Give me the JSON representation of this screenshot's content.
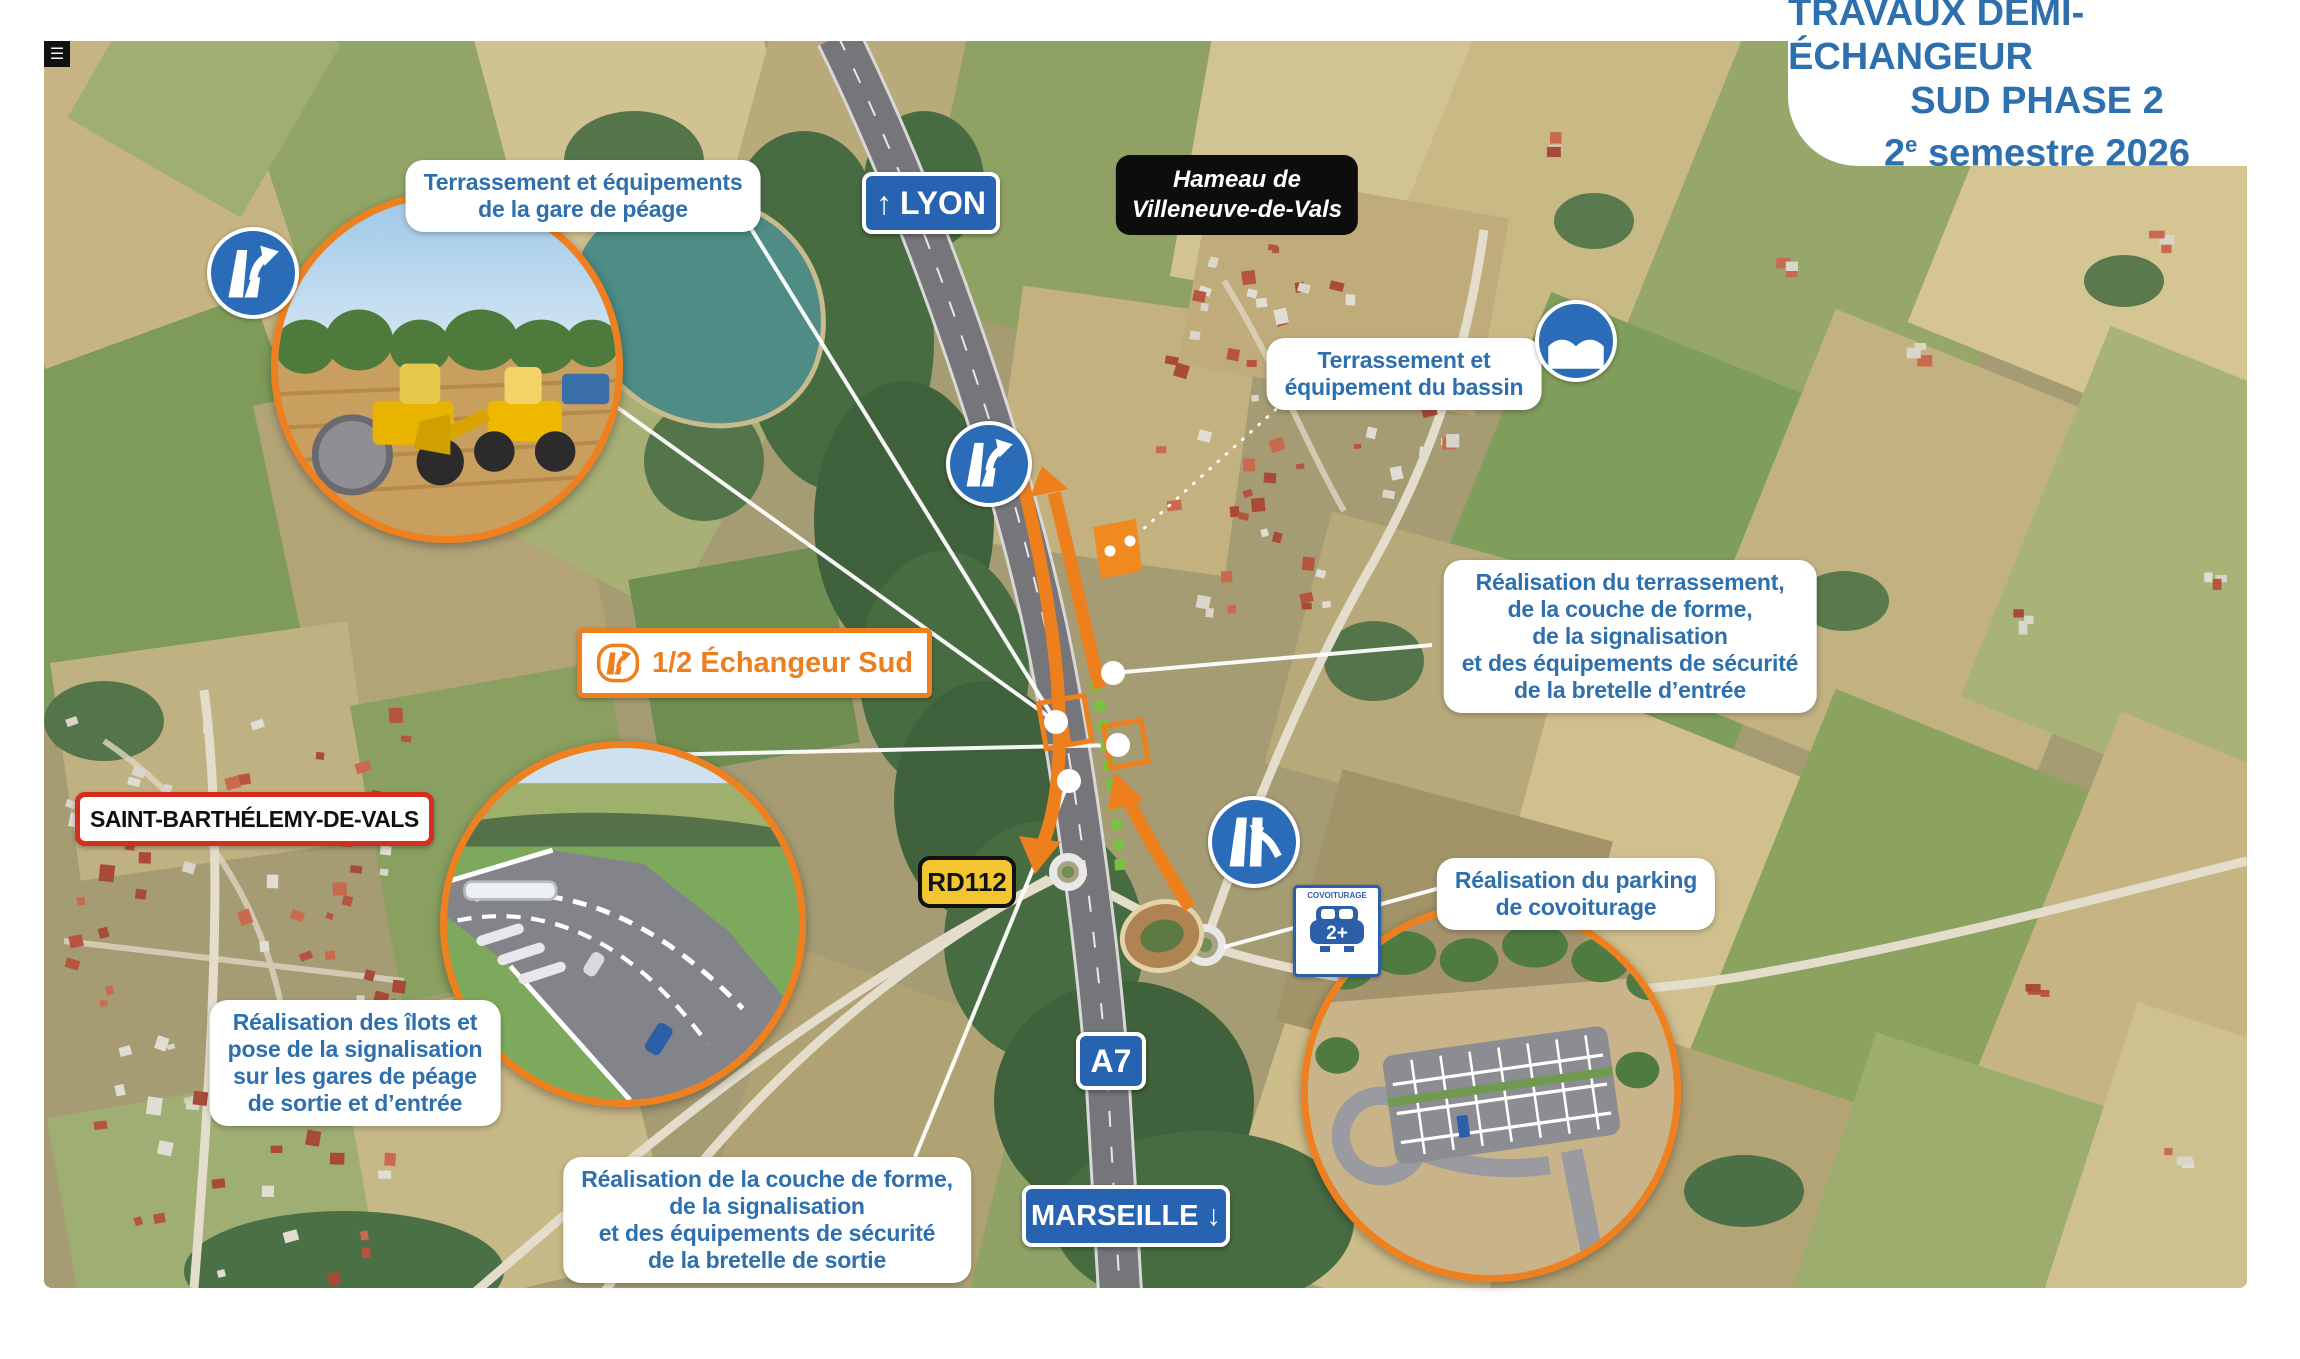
{
  "title": {
    "line1": "TRAVAUX DEMI-ÉCHANGEUR",
    "line2": "SUD PHASE 2",
    "line3_num": "2",
    "line3_sup": "e",
    "line3_rest": " semestre 2026"
  },
  "icons": {
    "menu_glyph": "☰",
    "lyon_arrow": "↑",
    "marseille_arrow": "↓"
  },
  "signs": {
    "lyon": {
      "label": "LYON"
    },
    "marseille": {
      "label": "MARSEILLE"
    },
    "a7": {
      "label": "A7"
    },
    "rd112": {
      "label": "RD112"
    },
    "hamlet": {
      "lines": [
        "Hameau de",
        "Villeneuve-de-Vals"
      ]
    },
    "town": {
      "label": "SAINT-BARTHÉLEMY-DE-VALS"
    },
    "interchange": {
      "label": "1/2 Échangeur Sud"
    }
  },
  "callouts": {
    "toll_terracing": {
      "lines": [
        "Terrassement et équipements",
        "de la gare de péage"
      ]
    },
    "basin": {
      "lines": [
        "Terrassement et",
        "équipement du bassin"
      ]
    },
    "entry_ramp": {
      "lines": [
        "Réalisation du terrassement,",
        "de la couche de forme,",
        "de la signalisation",
        "et des équipements de sécurité",
        "de la bretelle d’entrée"
      ]
    },
    "islands": {
      "lines": [
        "Réalisation des îlots et",
        "pose de la signalisation",
        "sur les gares de péage",
        "de sortie et d’entrée"
      ]
    },
    "exit_ramp": {
      "lines": [
        "Réalisation de la couche de forme,",
        "de la signalisation",
        "et des équipements de sécurité",
        "de la bretelle de sortie"
      ]
    },
    "carpool": {
      "lines": [
        "Réalisation du parking",
        "de covoiturage"
      ]
    }
  },
  "carpool_sign": {
    "top": "COVOITURAGE",
    "value": "2+"
  },
  "colors": {
    "accent_orange": "#ee7f1d",
    "text_blue": "#2e6fae",
    "sign_blue": "#2763b0",
    "dash_green": "#79c141",
    "sign_yellow": "#f2c531",
    "town_sign_border": "#d42e1f"
  }
}
